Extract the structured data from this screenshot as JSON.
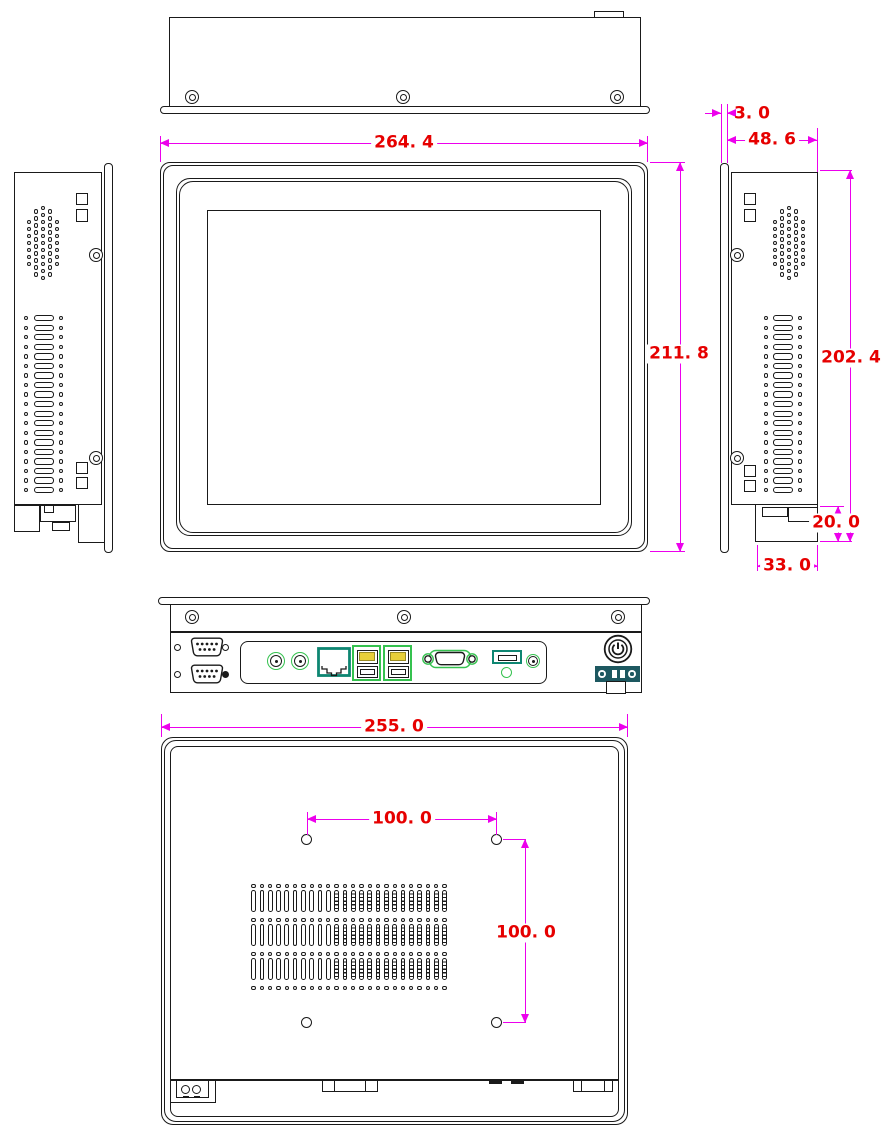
{
  "drawing": {
    "type": "multi-view technical dimension drawing",
    "subject": "industrial touch panel PC",
    "units": "mm",
    "background": "#ffffff",
    "colors": {
      "outline": "#1a1a1a",
      "dimension_line": "#ec00ec",
      "dimension_text": "#e60000",
      "connector_highlight": "#35c24f",
      "rj45_outline": "#0e8672",
      "usb_tongue": "#e8cf3a",
      "terminal_block": "#1d5860"
    },
    "views": {
      "top": "top view",
      "front": "front view with screen",
      "left": "left side view",
      "right": "right side view",
      "bottom": "bottom I/O view",
      "rear": "rear view with VESA mount holes"
    },
    "dimensions": {
      "top_width": "264. 4",
      "front_height": "211. 8",
      "panel_lip": "3. 0",
      "body_depth": "48. 6",
      "body_height": "202. 4",
      "bottom_step_height": "20. 0",
      "bottom_step_width": "33. 0",
      "rear_width": "255. 0",
      "vesa_pitch_horizontal": "100. 0",
      "vesa_pitch_vertical": "100. 0"
    },
    "io_ports": [
      "db9-serial",
      "db9-serial",
      "audio-jack",
      "audio-jack",
      "rj45-ethernet",
      "usb-stack-2x",
      "usb-stack-2x",
      "vga",
      "hdmi-slot",
      "indicator-hole",
      "dc-jack",
      "power-button",
      "power-terminal-block"
    ]
  }
}
